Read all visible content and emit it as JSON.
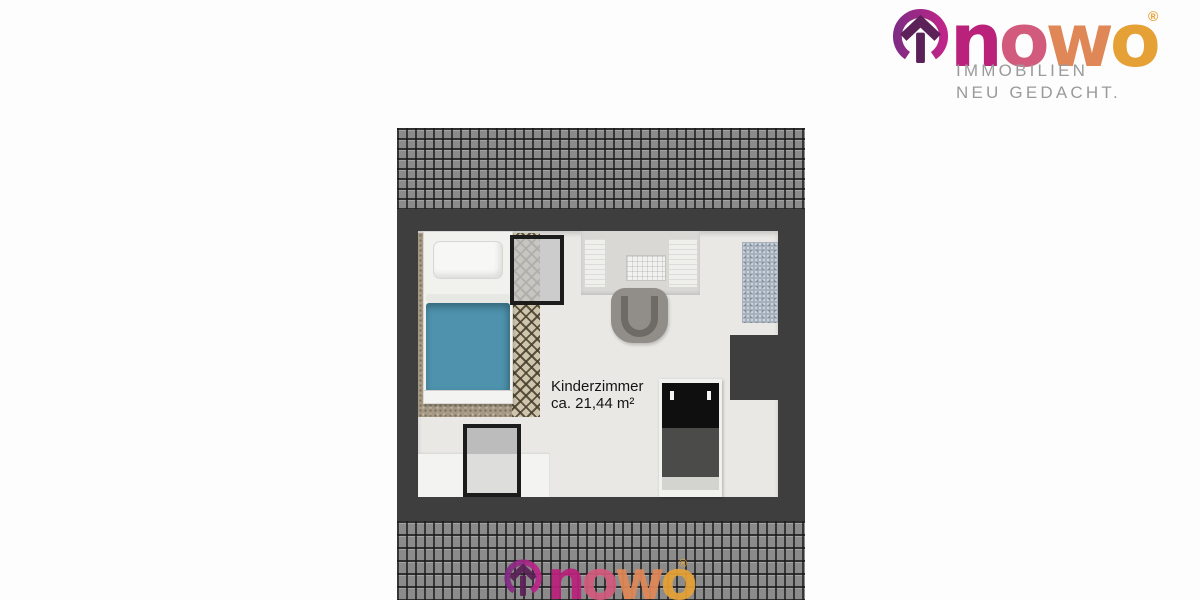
{
  "brand": {
    "wordmark_letters": [
      {
        "char": "n",
        "color": "#b9217b"
      },
      {
        "char": "o",
        "color": "#d25a7d"
      },
      {
        "char": "w",
        "color": "#e08757"
      },
      {
        "char": "o",
        "color": "#e6a136"
      }
    ],
    "registered_mark": "®",
    "tagline_line1": "IMMOBILIEN",
    "tagline_line2": "NEU GEDACHT.",
    "tagline_color": "#9a9a9a",
    "icon": {
      "name": "house-in-circle-icon",
      "ring_color_left": "#812c84",
      "ring_color_right": "#bf2489",
      "house_color": "#5c2158"
    }
  },
  "floorplan": {
    "room": {
      "name": "Kinderzimmer",
      "area": "ca. 21,44 m²"
    },
    "colors": {
      "wall": "#3e3e3e",
      "roof_tile": "#8b8b8b",
      "floor": "#e9e8e5",
      "bed_blanket": "#4e92ad",
      "rug": "#a69a85",
      "side_rug": "#a6b1bd",
      "window_frame": "#1c1c1c",
      "wardrobe_front": "#0f0f0f"
    },
    "furniture": [
      "bed",
      "rug",
      "skylight-window",
      "desk",
      "desk-chair",
      "side-rug",
      "wardrobe",
      "dormer-window",
      "low-cabinet"
    ]
  }
}
